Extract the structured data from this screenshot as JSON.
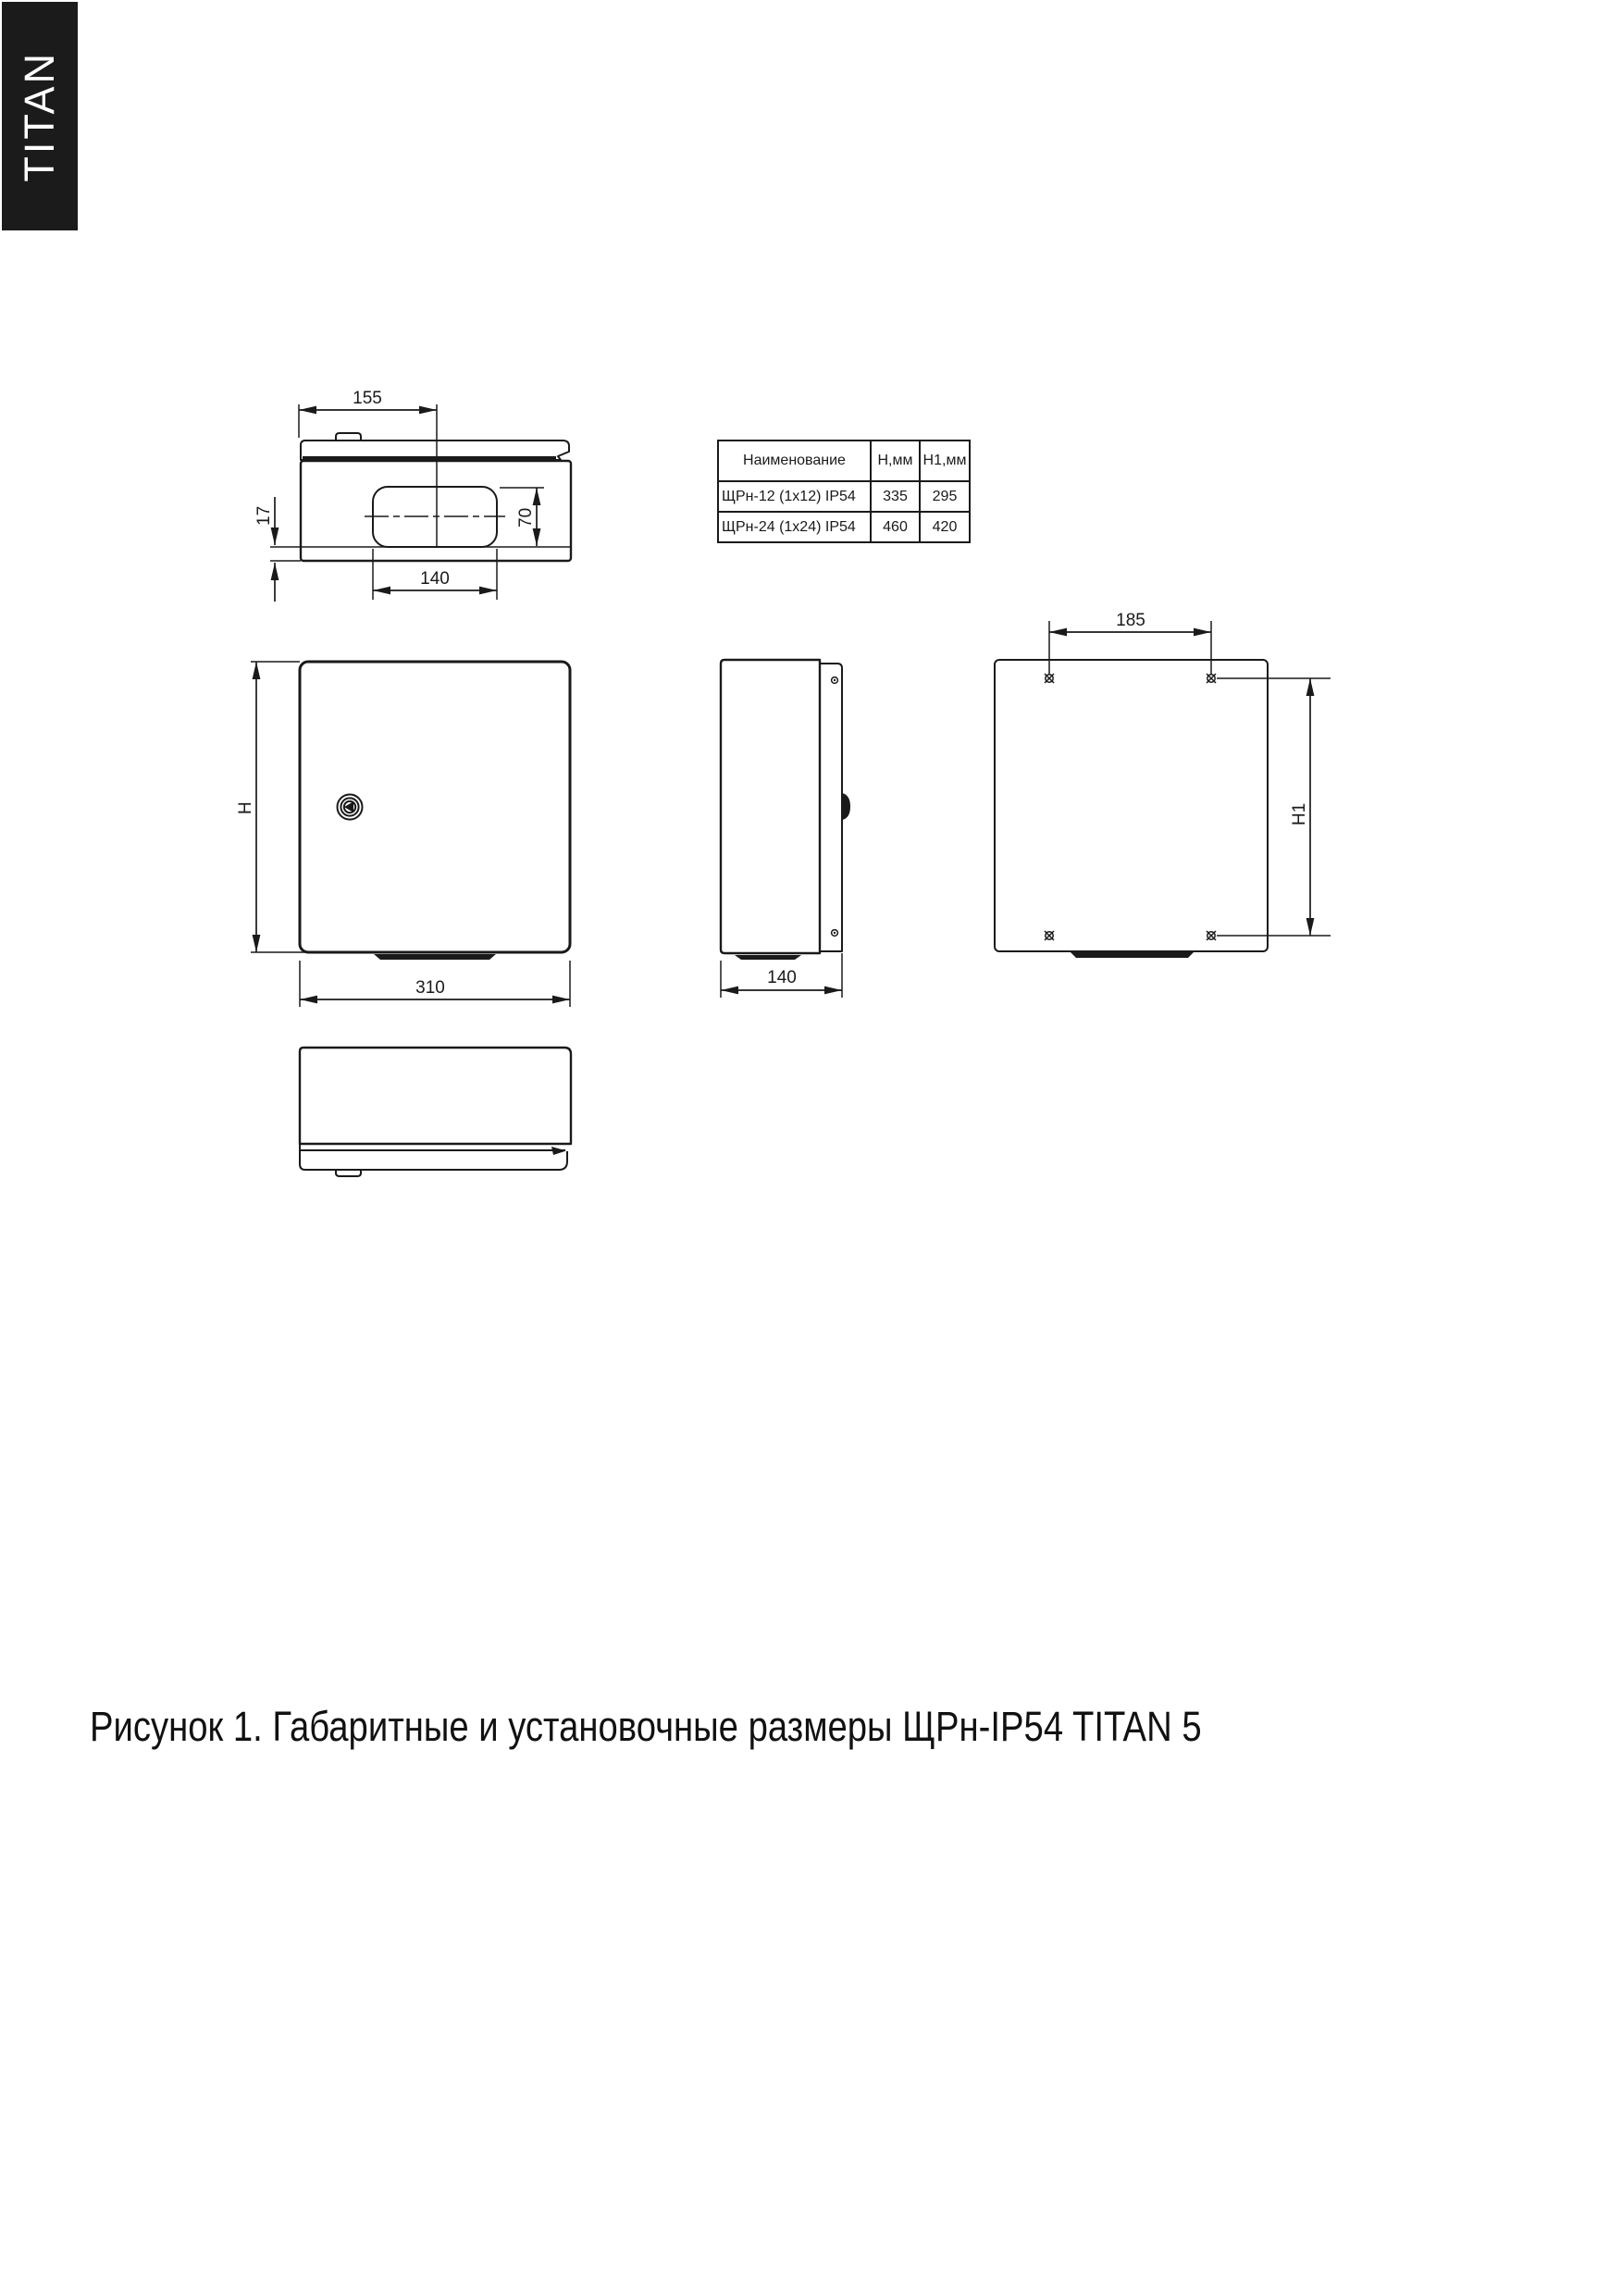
{
  "brand": "TITAN",
  "caption": "Рисунок 1. Габаритные и установочные размеры ЩРн-IP54 TITAN 5",
  "table": {
    "headers": [
      "Наименование",
      "Н,мм",
      "Н1,мм"
    ],
    "rows": [
      [
        "ЩРн-12 (1x12) IP54",
        "335",
        "295"
      ],
      [
        "ЩРн-24 (1x24) IP54",
        "460",
        "420"
      ]
    ]
  },
  "dims": {
    "top_width": "155",
    "top_flange": "17",
    "cutout_height": "70",
    "cutout_width": "140",
    "front_height": "H",
    "front_width": "310",
    "side_depth": "140",
    "mount_spacing_w": "185",
    "mount_spacing_h": "H1"
  }
}
